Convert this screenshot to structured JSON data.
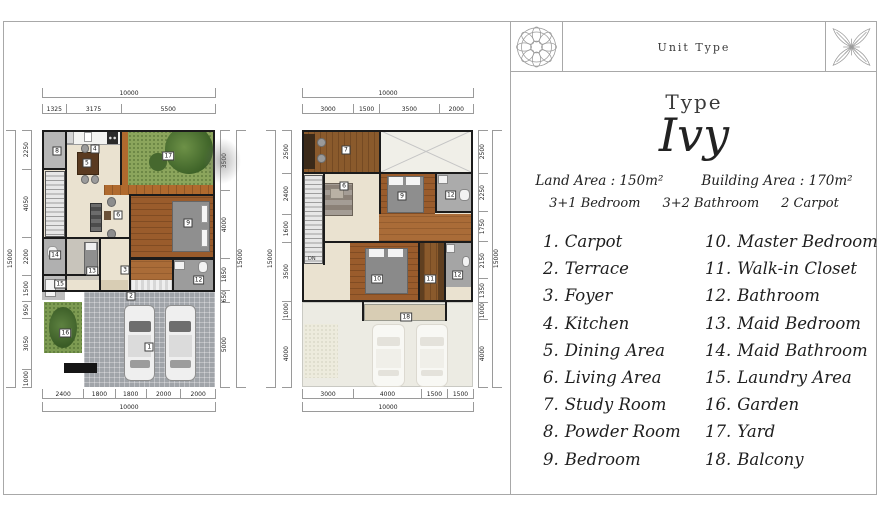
{
  "panel": {
    "header_title": "Unit Type",
    "type_label": "Type",
    "type_name": "Ivy",
    "land_area": "Land Area : 150m²",
    "building_area": "Building Area : 170m²",
    "spec": {
      "bedroom": "3+1 Bedroom",
      "bathroom": "3+2 Bathroom",
      "carport": "2 Carpot"
    },
    "legend_left": [
      {
        "num": "1.",
        "label": "Carpot"
      },
      {
        "num": "2.",
        "label": "Terrace"
      },
      {
        "num": "3.",
        "label": "Foyer"
      },
      {
        "num": "4.",
        "label": "Kitchen"
      },
      {
        "num": "5.",
        "label": "Dining Area"
      },
      {
        "num": "6.",
        "label": "Living Area"
      },
      {
        "num": "7.",
        "label": "Study Room"
      },
      {
        "num": "8.",
        "label": "Powder Room"
      },
      {
        "num": "9.",
        "label": "Bedroom"
      }
    ],
    "legend_right": [
      {
        "num": "10.",
        "label": "Master Bedroom"
      },
      {
        "num": "11.",
        "label": "Walk-in Closet"
      },
      {
        "num": "12.",
        "label": "Bathroom"
      },
      {
        "num": "13.",
        "label": "Maid Bedroom"
      },
      {
        "num": "14.",
        "label": "Maid Bathroom"
      },
      {
        "num": "15.",
        "label": "Laundry Area"
      },
      {
        "num": "16.",
        "label": "Garden"
      },
      {
        "num": "17.",
        "label": "Yard"
      },
      {
        "num": "18.",
        "label": "Balcony"
      }
    ]
  },
  "plans": {
    "ground": {
      "top_total": "10000",
      "top": [
        "1325",
        "3175",
        "5500"
      ],
      "bottom": [
        "2400",
        "1800",
        "1800",
        "2000",
        "2000"
      ],
      "bottom_total": "10000",
      "left_total": "15000",
      "left": [
        "2250",
        "4050",
        "2200",
        "1500",
        "950",
        "3050",
        "1000"
      ],
      "right": [
        "3500",
        "4000",
        "1850",
        "650",
        "5000"
      ],
      "right_total": "15000",
      "markers": [
        "8",
        "4",
        "5",
        "17",
        "6",
        "9",
        "14",
        "15",
        "13",
        "3",
        "2",
        "12",
        "16",
        "1"
      ]
    },
    "upper": {
      "top_total": "10000",
      "top": [
        "3000",
        "1500",
        "3500",
        "2000"
      ],
      "bottom": [
        "3000",
        "4000",
        "1500",
        "1500"
      ],
      "bottom_total": "10000",
      "left_total": "15000",
      "left": [
        "2500",
        "2400",
        "1600",
        "3500",
        "1000",
        "4000"
      ],
      "right": [
        "2500",
        "2250",
        "1750",
        "2150",
        "1350",
        "1000",
        "4000"
      ],
      "right_total": "15000",
      "stairs_label": "DN",
      "markers": [
        "7",
        "6",
        "9",
        "12",
        "10",
        "11",
        "12",
        "18"
      ]
    }
  },
  "colors": {
    "wall": "#1b1b1b",
    "floor_cream": "#eae2d0",
    "wood_floor": "#9a5c2c",
    "yard_green": "#8ba55c",
    "driveway_gray": "#a0a4a9",
    "terrace_tan": "#d8cdb4"
  }
}
